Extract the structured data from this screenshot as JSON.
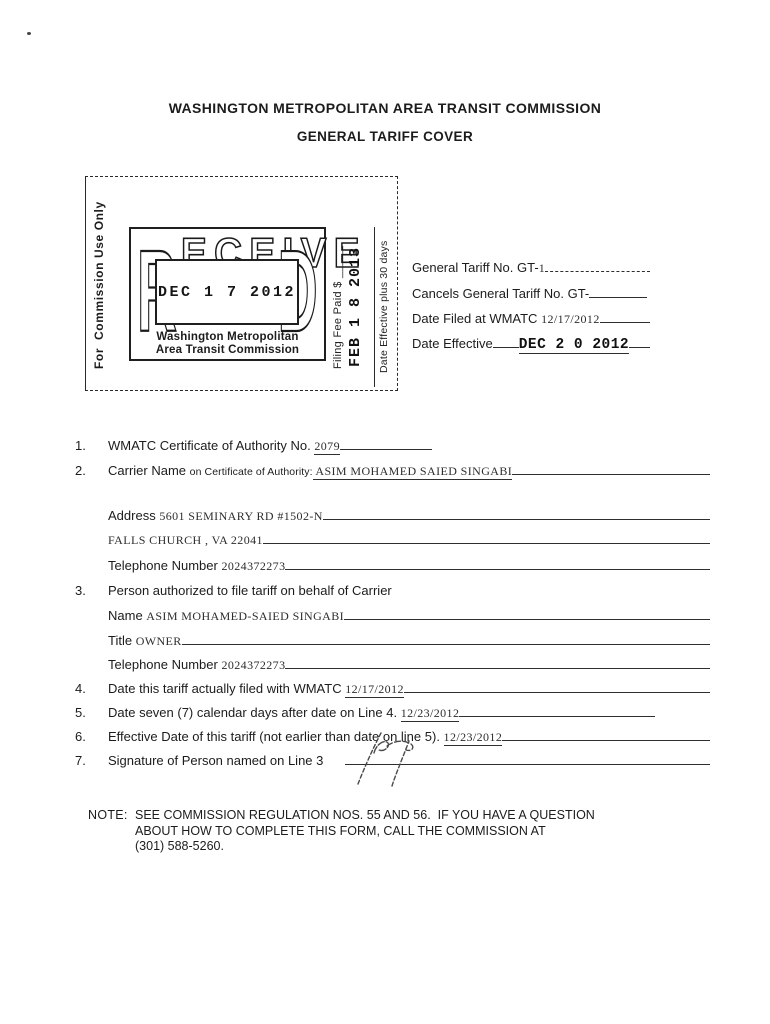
{
  "page": {
    "title_line1": "WASHINGTON METROPOLITAN AREA TRANSIT COMMISSION",
    "title_line2": "GENERAL TARIFF COVER"
  },
  "commission_box": {
    "side_label": "For  Commission Use Only",
    "received_stamp": {
      "letter_r": "R",
      "letters_mid": "ECEIVE",
      "letter_d": "D",
      "date": "DEC 1 7 2012",
      "org_line1": "Washington Metropolitan",
      "org_line2": "Area Transit Commission"
    },
    "filing_fee_label": "Filing Fee Paid $ _____",
    "fee_date_stamp": "FEB 1 8 2013",
    "effective_label": "Date Effective plus 30 days"
  },
  "tariff_fields": {
    "general_no": {
      "label": "General Tariff No. GT-",
      "value": "1"
    },
    "cancels": {
      "label": "Cancels General Tariff No. GT-"
    },
    "date_filed": {
      "label": "Date Filed at WMATC ",
      "value": "12/17/2012"
    },
    "date_effective": {
      "label": "Date Effective",
      "value": "DEC 2 0 2012"
    }
  },
  "form": {
    "item1": {
      "num": "1.",
      "label": "WMATC Certificate of Authority No. ",
      "value": "2079"
    },
    "item2": {
      "num": "2.",
      "label": "Carrier Name ",
      "sublabel": "on Certificate of Authority:",
      "value": " ASIM MOHAMED SAIED SINGABI"
    },
    "address1": {
      "label": "Address ",
      "value": "5601 SEMINARY RD #1502-N"
    },
    "address2": {
      "value": "FALLS CHURCH , VA 22041"
    },
    "phone1": {
      "label": "Telephone Number ",
      "value": "2024372273"
    },
    "item3": {
      "num": "3.",
      "label": "Person authorized to file tariff on behalf of Carrier"
    },
    "name": {
      "label": "Name ",
      "value": "ASIM MOHAMED-SAIED SINGABI"
    },
    "title": {
      "label": "Title ",
      "value": "OWNER"
    },
    "phone2": {
      "label": "Telephone Number ",
      "value": "2024372273"
    },
    "item4": {
      "num": "4.",
      "label": "Date this tariff actually filed with WMATC ",
      "value": "12/17/2012"
    },
    "item5": {
      "num": "5.",
      "label": "Date seven (7) calendar days after date on Line 4. ",
      "value": "12/23/2012"
    },
    "item6": {
      "num": "6.",
      "label": "Effective Date of this tariff (not earlier than date on line 5). ",
      "value": "12/23/2012"
    },
    "item7": {
      "num": "7.",
      "label": "Signature of Person named on Line 3"
    }
  },
  "note": {
    "label": "NOTE:",
    "line1": "SEE COMMISSION REGULATION NOS. 55 AND 56.  IF YOU HAVE A QUESTION",
    "line2": "ABOUT HOW TO COMPLETE THIS FORM, CALL THE COMMISSION AT",
    "line3": "(301) 588-5260."
  }
}
